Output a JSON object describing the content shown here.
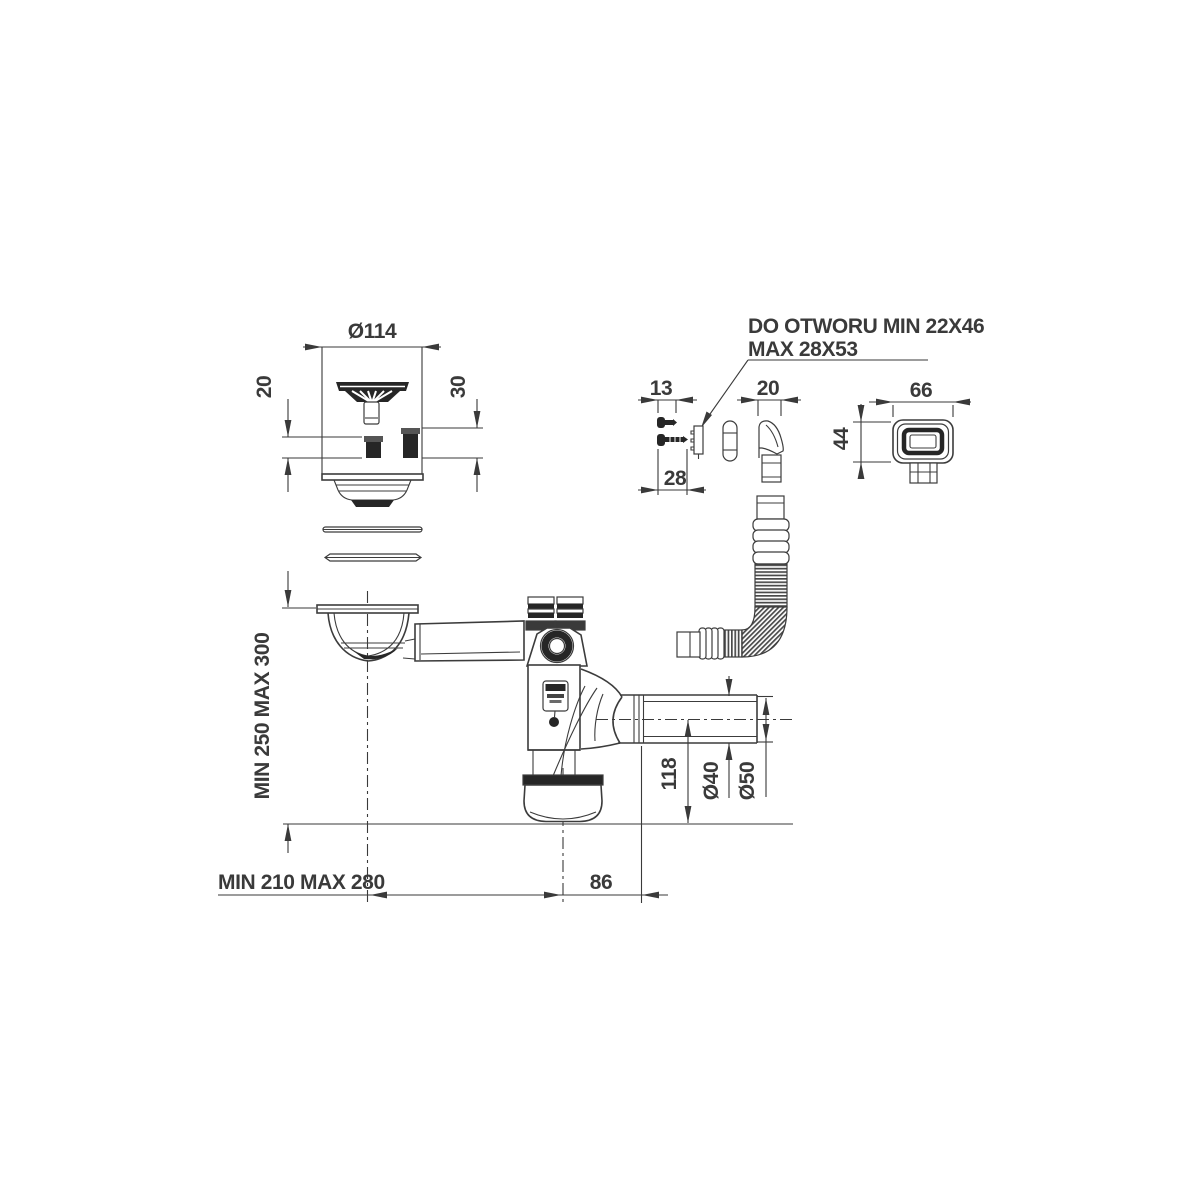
{
  "note": {
    "line1": "DO OTWORU MIN 22X46",
    "line2": "MAX 28X53"
  },
  "dimensions": {
    "strainer_diameter": "Ø114",
    "plug_small_height": "20",
    "plug_large_height": "30",
    "screw_short_length": "13",
    "screw_long_length": "28",
    "overflow_connector_width": "20",
    "overflow_cover_width": "66",
    "overflow_cover_height": "44",
    "vertical_range": "MIN 250 MAX 300",
    "horizontal_range": "MIN 210 MAX 280",
    "outlet_axis_to_trap_bottom": "118",
    "outlet_inner_diameter": "Ø40",
    "outlet_outer_diameter": "Ø50",
    "trap_axis_to_pipe_joint": "86"
  },
  "colors": {
    "background": "#ffffff",
    "line": "#3c3c3c",
    "dim": "#3a3a3a",
    "dark": "#262626"
  }
}
